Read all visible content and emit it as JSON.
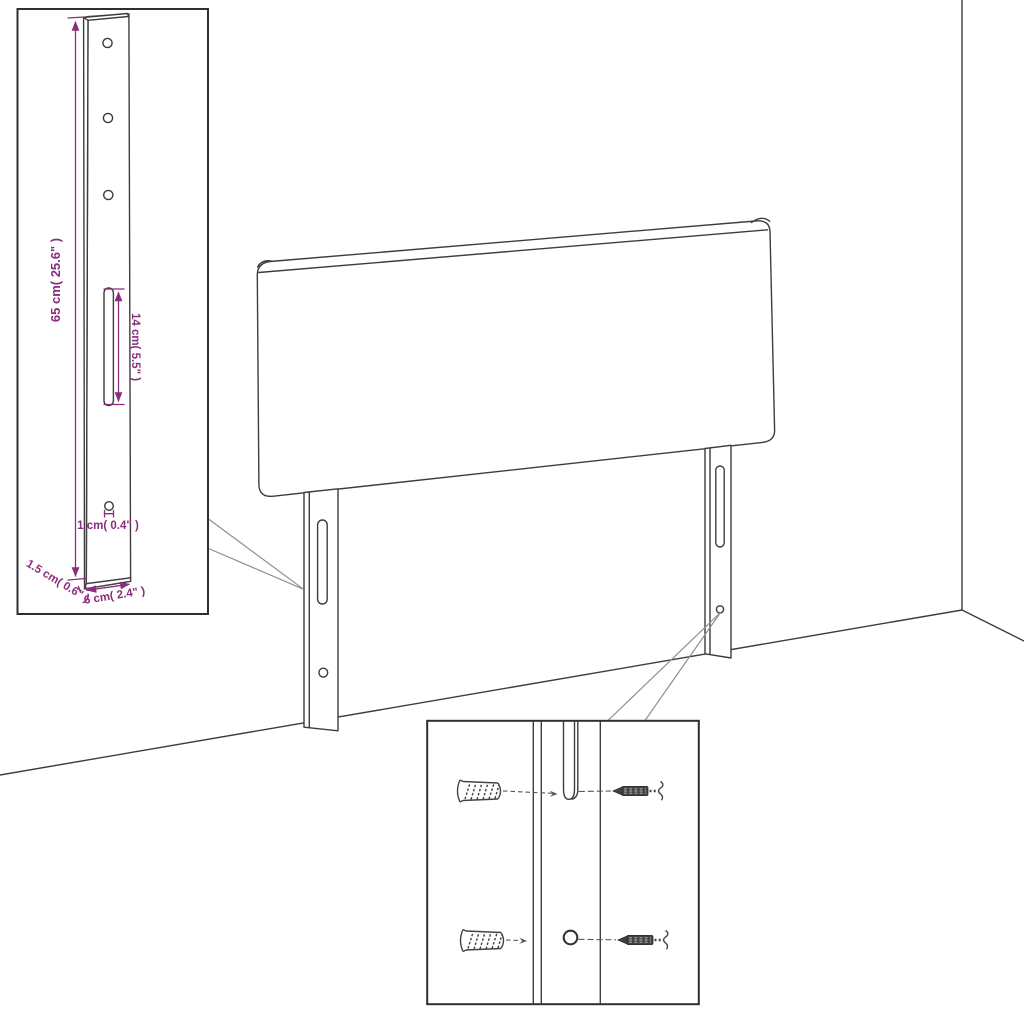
{
  "page": {
    "background": "#ffffff",
    "description": "Black line-art assembly diagram of an upholstered headboard with two rear mounting legs shown in a room corner, with a magnified leg-dimension inset (top left) and a wall-fixing hardware inset (bottom centre)."
  },
  "colors": {
    "outline": "#3D3D3D",
    "inset_border": "#2F2F2F",
    "dimension_text": "#8B2C7E",
    "callout_line": "#8F8F8F"
  },
  "leg_detail_inset": {
    "dimensions": {
      "height": "65 cm( 25.6\" )",
      "slot_length": "14 cm( 5.5\" )",
      "hole_diameter": "1 cm( 0.4\" )",
      "thickness": "1.5 cm( 0.6\" )",
      "width": "6 cm( 2.4\" )"
    },
    "features": {
      "screw_holes": 3,
      "adjustment_slot": 1,
      "pin_hole": 1
    }
  },
  "mounting_detail_inset": {
    "features": {
      "wall_plugs": 2,
      "screws": 2,
      "slot": 1,
      "hole": 1
    }
  }
}
